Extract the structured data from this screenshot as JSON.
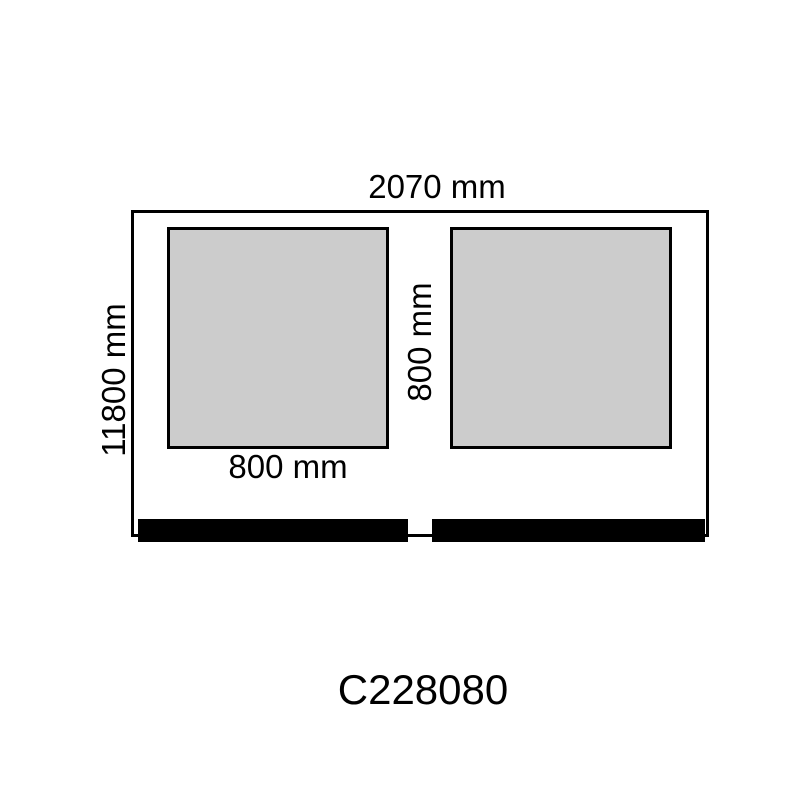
{
  "diagram": {
    "product_code": "C228080",
    "dimensions": {
      "overall_width_label": "2070 mm",
      "overall_height_label": "11800 mm",
      "panel_height_label": "800 mm",
      "panel_width_label": "800 mm"
    },
    "shapes": {
      "panel_count": 2,
      "base_bar_count": 2
    },
    "colors": {
      "background": "#ffffff",
      "outline": "#000000",
      "panel_fill": "#cccccc",
      "base_bar_fill": "#000000",
      "text": "#000000"
    }
  }
}
